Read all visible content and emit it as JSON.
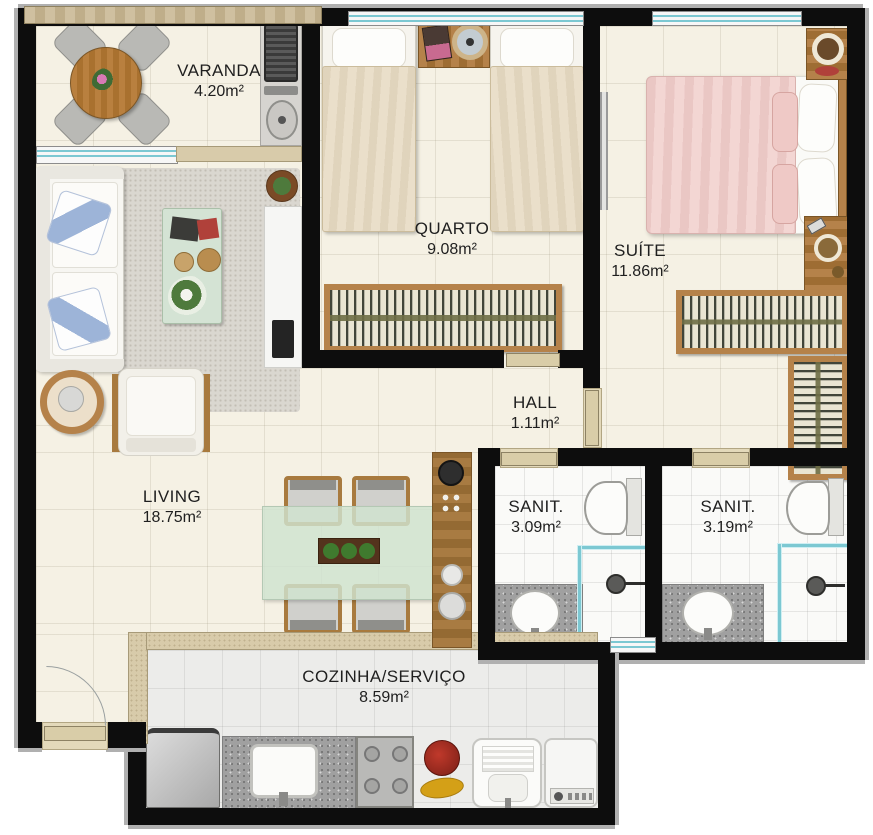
{
  "plan": {
    "type": "apartment-floor-plan",
    "rooms": [
      {
        "id": "varanda",
        "name": "VARANDA",
        "area": "4.20m²"
      },
      {
        "id": "quarto",
        "name": "QUARTO",
        "area": "9.08m²"
      },
      {
        "id": "suite",
        "name": "SUÍTE",
        "area": "11.86m²"
      },
      {
        "id": "hall",
        "name": "HALL",
        "area": "1.11m²"
      },
      {
        "id": "living",
        "name": "LIVING",
        "area": "18.75m²"
      },
      {
        "id": "sanit1",
        "name": "SANIT.",
        "area": "3.09m²"
      },
      {
        "id": "sanit2",
        "name": "SANIT.",
        "area": "3.19m²"
      },
      {
        "id": "cozinha",
        "name": "COZINHA/SERVIÇO",
        "area": "8.59m²"
      }
    ],
    "furniture": {
      "varanda": [
        "round-wood-table",
        "four-chairs",
        "flower-centerpiece",
        "grill",
        "prep-sink"
      ],
      "living": [
        "sofa-with-blue-pillows",
        "area-rug",
        "coffee-table",
        "round-side-table",
        "armchair",
        "tv-console",
        "tv",
        "potted-plant"
      ],
      "dining": [
        "glass-dining-table",
        "four-wood-chairs",
        "planter-centerpiece",
        "wood-sideboard-with-clock"
      ],
      "quarto": [
        "single-bed",
        "single-bed",
        "nightstand-with-clock",
        "wardrobe-hangers"
      ],
      "suite": [
        "double-bed-pink",
        "vanity-with-mirror",
        "side-desk",
        "l-shaped-wardrobe",
        "wall-mirror"
      ],
      "sanit1": [
        "toilet",
        "glass-shower",
        "granite-counter-washbasin"
      ],
      "sanit2": [
        "toilet",
        "glass-shower",
        "granite-counter-washbasin"
      ],
      "cozinha": [
        "fridge",
        "granite-counter-sink",
        "stove-4-burners",
        "fruit-decor",
        "laundry-tub",
        "washing-machine"
      ]
    }
  },
  "colors": {
    "wall": "#0d0d0d",
    "floor_cream": "#f5f1e4",
    "floor_gray": "#ececea",
    "partition": "#d8cbaa",
    "wood": "#b5824a",
    "glass_teal": "#7cc8d2",
    "rug": "#dad7d0",
    "granite": "#a0a0a0",
    "mint": "#d4e3d4",
    "bed_beige": "#eadfca",
    "bed_pink": "#f3d6d3",
    "pillow_blue": "#9db4d8",
    "door_leaf": "#d9cda8",
    "label_text": "#1f1f1f"
  }
}
